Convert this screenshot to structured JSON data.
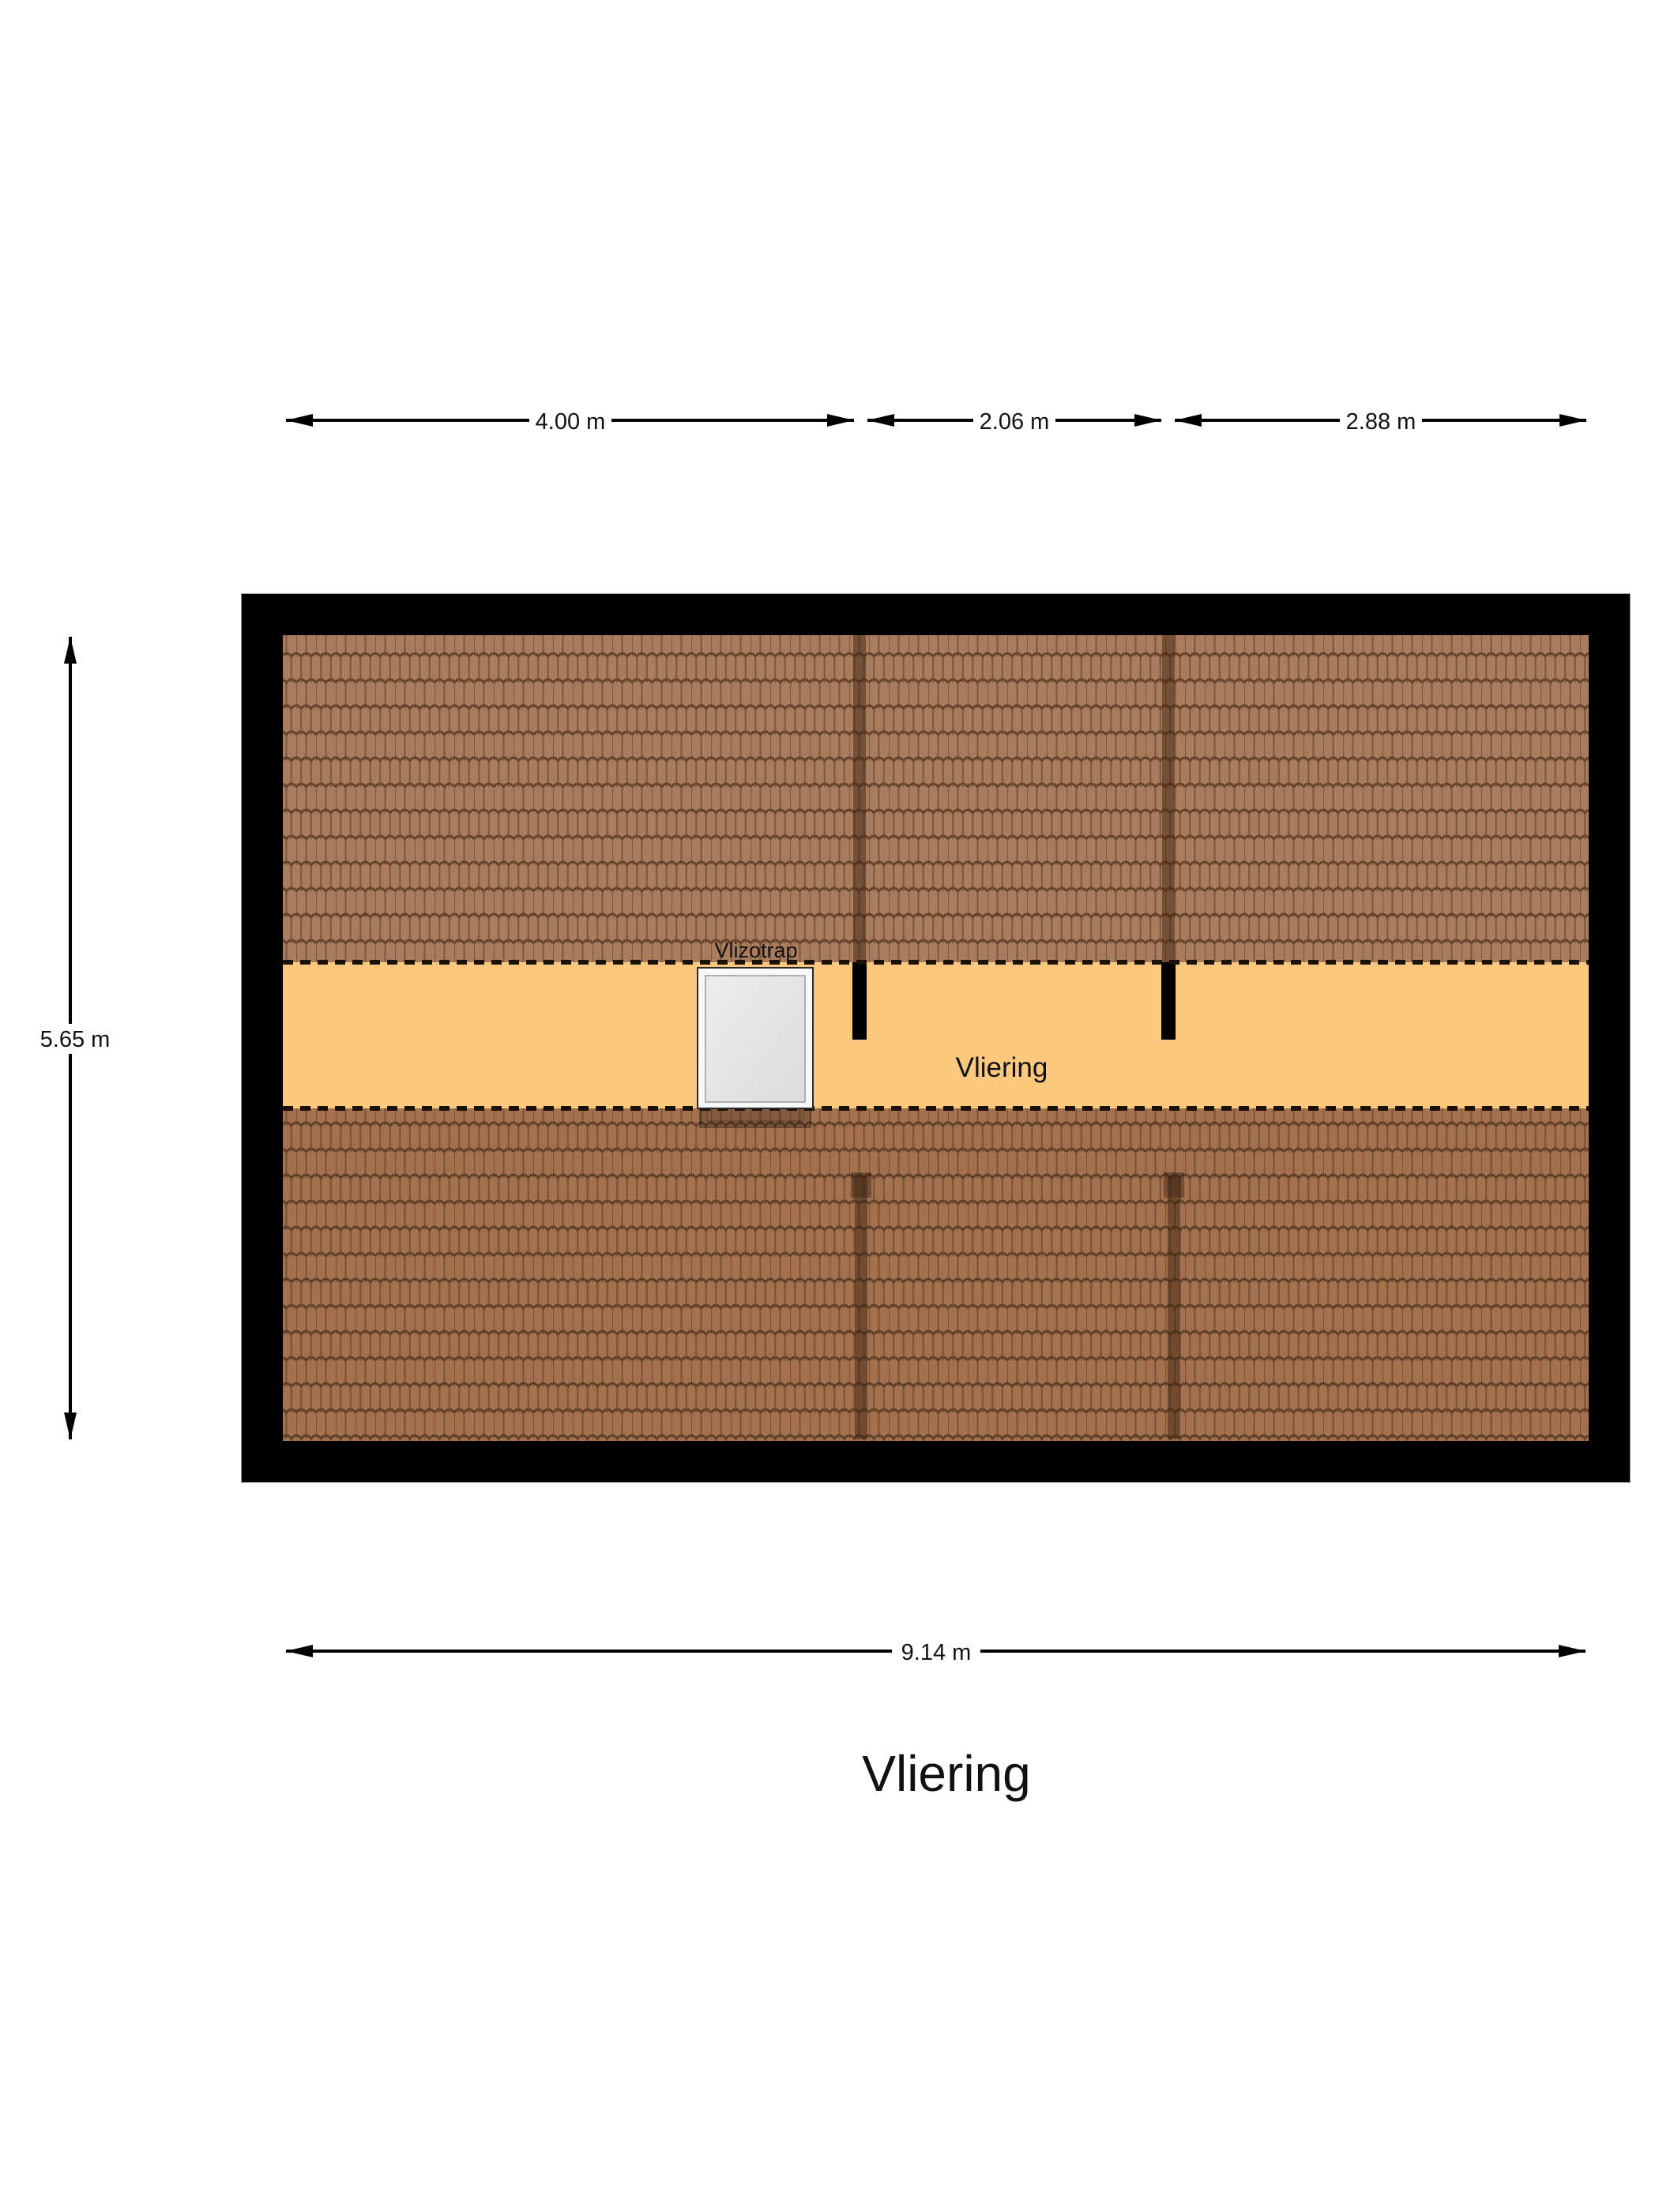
{
  "plan": {
    "room_label": "Vliering",
    "hatch_label": "Vlizotrap",
    "title": "Vliering"
  },
  "dimensions": {
    "top": [
      {
        "label": "4.00 m"
      },
      {
        "label": "2.06 m"
      },
      {
        "label": "2.88 m"
      }
    ],
    "left": {
      "label": "5.65 m"
    },
    "bottom": {
      "label": "9.14 m"
    }
  },
  "colors": {
    "floor": "#fbc87d",
    "tile_top_base": "#a97c5d",
    "tile_bottom_base": "#a4714f",
    "frame": "#000000",
    "hatch_outer": "#f7f7f7",
    "hatch_inner": "#e2e2e2"
  }
}
